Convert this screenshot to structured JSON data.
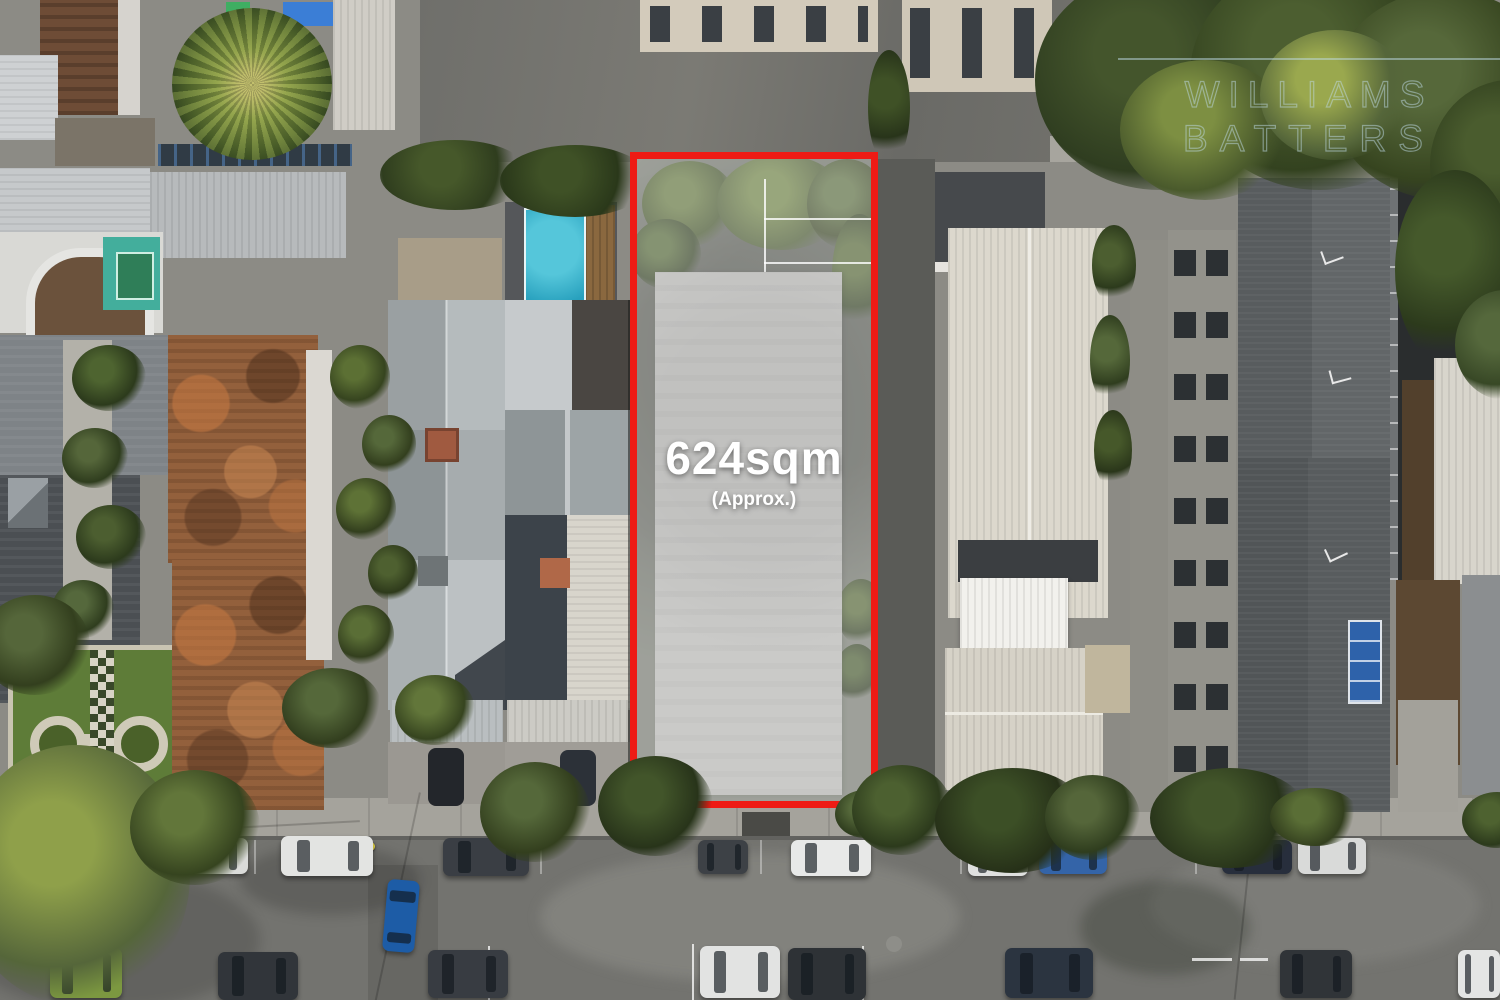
{
  "image": {
    "description": "Aerial drone photograph of an inner-suburban block; a vacant development site is outlined in red with its land area labelled.",
    "lot_label": {
      "area": "624sqm",
      "qualifier": "(Approx.)"
    },
    "watermark": {
      "line1": "WILLIAMS",
      "line2": "BATTERS"
    },
    "colors": {
      "outline_red": "#ee1b15",
      "overlay_white": "rgba(255,255,255,0.32)",
      "label_text": "#ffffff",
      "watermark_text": "rgba(190,218,230,0.5)",
      "pool_teal": "#27a0bd",
      "terracotta_roof": "#93603c",
      "asphalt": "#73736f"
    }
  },
  "cars": [
    {
      "x": 30,
      "y": 841,
      "w": 54,
      "h": 34,
      "c": "#b9bbbd",
      "o": "h"
    },
    {
      "x": 124,
      "y": 839,
      "w": 46,
      "h": 33,
      "c": "#e6e7e7",
      "o": "h"
    },
    {
      "x": 176,
      "y": 838,
      "w": 72,
      "h": 36,
      "c": "#dadbd9",
      "o": "h"
    },
    {
      "x": 281,
      "y": 836,
      "w": 92,
      "h": 40,
      "c": "#e3e4e2",
      "o": "h"
    },
    {
      "x": 443,
      "y": 838,
      "w": 86,
      "h": 38,
      "c": "#3a3e44",
      "o": "h"
    },
    {
      "x": 698,
      "y": 840,
      "w": 50,
      "h": 34,
      "c": "#3d4146",
      "o": "h"
    },
    {
      "x": 791,
      "y": 840,
      "w": 80,
      "h": 36,
      "c": "#e8e9e8",
      "o": "h"
    },
    {
      "x": 968,
      "y": 842,
      "w": 60,
      "h": 34,
      "c": "#dfe0df",
      "o": "h"
    },
    {
      "x": 1039,
      "y": 840,
      "w": 68,
      "h": 34,
      "c": "#3464a8",
      "o": "h"
    },
    {
      "x": 1222,
      "y": 840,
      "w": 70,
      "h": 34,
      "c": "#272e3c",
      "o": "h"
    },
    {
      "x": 1298,
      "y": 838,
      "w": 68,
      "h": 36,
      "c": "#d9dad9",
      "o": "h"
    },
    {
      "x": 385,
      "y": 880,
      "w": 32,
      "h": 72,
      "c": "#1d5ca6",
      "o": "v",
      "deg": 5
    },
    {
      "x": 50,
      "y": 948,
      "w": 72,
      "h": 50,
      "c": "#7c9840",
      "o": "h"
    },
    {
      "x": 218,
      "y": 952,
      "w": 80,
      "h": 48,
      "c": "#31353a",
      "o": "h"
    },
    {
      "x": 428,
      "y": 950,
      "w": 80,
      "h": 48,
      "c": "#383c42",
      "o": "h"
    },
    {
      "x": 700,
      "y": 946,
      "w": 80,
      "h": 52,
      "c": "#e2e3e2",
      "o": "h"
    },
    {
      "x": 788,
      "y": 948,
      "w": 78,
      "h": 52,
      "c": "#2e3236",
      "o": "h"
    },
    {
      "x": 1005,
      "y": 948,
      "w": 88,
      "h": 50,
      "c": "#2b3440",
      "o": "h"
    },
    {
      "x": 1280,
      "y": 950,
      "w": 72,
      "h": 48,
      "c": "#303438",
      "o": "h"
    },
    {
      "x": 1458,
      "y": 950,
      "w": 42,
      "h": 48,
      "c": "#e4e5e4",
      "o": "h"
    }
  ],
  "trees": [
    {
      "layer": "scene",
      "x": 1035,
      "y": -30,
      "w": 250,
      "h": 220,
      "c1": "#44552c",
      "c2": "#2f3d20"
    },
    {
      "layer": "scene",
      "x": 1190,
      "y": -40,
      "w": 260,
      "h": 230,
      "c1": "#4c5e30",
      "c2": "#33421f"
    },
    {
      "layer": "scene",
      "x": 1330,
      "y": -10,
      "w": 230,
      "h": 210,
      "c1": "#56683a",
      "c2": "#36441f"
    },
    {
      "layer": "scene",
      "x": 1430,
      "y": 80,
      "w": 160,
      "h": 170,
      "c1": "#4a5c2e",
      "c2": "#2f3d1d"
    },
    {
      "layer": "scene",
      "x": 1120,
      "y": 60,
      "w": 170,
      "h": 140,
      "c1": "#7d8f42",
      "c2": "#4a5a2c"
    },
    {
      "layer": "scene",
      "x": 1260,
      "y": 30,
      "w": 150,
      "h": 130,
      "c1": "#9aa84e",
      "c2": "#55663a"
    },
    {
      "layer": "scene",
      "x": 1395,
      "y": 170,
      "w": 120,
      "h": 200,
      "c1": "#45592b",
      "c2": "#2c3a1c"
    },
    {
      "layer": "scene",
      "x": 1455,
      "y": 290,
      "w": 100,
      "h": 110,
      "c1": "#55683c",
      "c2": "#384826"
    },
    {
      "layer": "scene",
      "x": 380,
      "y": 140,
      "w": 150,
      "h": 70,
      "c1": "#46582a",
      "c2": "#2f3d1e"
    },
    {
      "layer": "scene",
      "x": 500,
      "y": 145,
      "w": 150,
      "h": 72,
      "c1": "#3f5126",
      "c2": "#2a381a"
    },
    {
      "layer": "scene",
      "x": 868,
      "y": 50,
      "w": 42,
      "h": 115,
      "c1": "#3f5126",
      "c2": "#28341a"
    },
    {
      "layer": "scene",
      "x": 330,
      "y": 345,
      "w": 60,
      "h": 64,
      "c1": "#5c7034",
      "c2": "#36441f"
    },
    {
      "layer": "scene",
      "x": 362,
      "y": 415,
      "w": 54,
      "h": 58,
      "c1": "#55683a",
      "c2": "#333f1e"
    },
    {
      "layer": "scene",
      "x": 336,
      "y": 478,
      "w": 60,
      "h": 62,
      "c1": "#5e7236",
      "c2": "#333f1e"
    },
    {
      "layer": "scene",
      "x": 368,
      "y": 545,
      "w": 50,
      "h": 56,
      "c1": "#4e6030",
      "c2": "#2e3a1b"
    },
    {
      "layer": "scene",
      "x": 338,
      "y": 605,
      "w": 56,
      "h": 60,
      "c1": "#5a6e36",
      "c2": "#333f1e"
    },
    {
      "layer": "scene",
      "x": 282,
      "y": 668,
      "w": 100,
      "h": 80,
      "c1": "#55683a",
      "c2": "#323e1e"
    },
    {
      "layer": "scene",
      "x": 395,
      "y": 675,
      "w": 80,
      "h": 70,
      "c1": "#62763a",
      "c2": "#36441f"
    },
    {
      "layer": "scene",
      "x": 72,
      "y": 345,
      "w": 74,
      "h": 66,
      "c1": "#4e6430",
      "c2": "#2c3a1c"
    },
    {
      "layer": "scene",
      "x": 62,
      "y": 428,
      "w": 66,
      "h": 60,
      "c1": "#55663a",
      "c2": "#2f3d1e"
    },
    {
      "layer": "scene",
      "x": 76,
      "y": 505,
      "w": 70,
      "h": 64,
      "c1": "#4c5e30",
      "c2": "#2c3a1c"
    },
    {
      "layer": "scene",
      "x": 52,
      "y": 580,
      "w": 62,
      "h": 58,
      "c1": "#55683c",
      "c2": "#2f3d1e"
    },
    {
      "layer": "scene",
      "x": -20,
      "y": 595,
      "w": 110,
      "h": 100,
      "c1": "#55663a",
      "c2": "#333f1e"
    },
    {
      "layer": "scene",
      "x": 1092,
      "y": 225,
      "w": 44,
      "h": 80,
      "c1": "#4c5e30",
      "c2": "#2c3a1c"
    },
    {
      "layer": "scene",
      "x": 1090,
      "y": 315,
      "w": 40,
      "h": 90,
      "c1": "#55683a",
      "c2": "#2f3d1e"
    },
    {
      "layer": "scene",
      "x": 1094,
      "y": 410,
      "w": 38,
      "h": 80,
      "c1": "#46582a",
      "c2": "#2a361a"
    },
    {
      "layer": "site",
      "x": 5,
      "y": 2,
      "w": 95,
      "h": 85,
      "c1": "#5d7038",
      "c2": "#3c4c24"
    },
    {
      "layer": "site",
      "x": 80,
      "y": -4,
      "w": 130,
      "h": 95,
      "c1": "#687c3e",
      "c2": "#42522a"
    },
    {
      "layer": "site",
      "x": 170,
      "y": 0,
      "w": 80,
      "h": 90,
      "c1": "#55683a",
      "c2": "#333f1e"
    },
    {
      "layer": "site",
      "x": -6,
      "y": 60,
      "w": 70,
      "h": 70,
      "c1": "#4c6030",
      "c2": "#2c3a1c"
    },
    {
      "layer": "site",
      "x": 195,
      "y": 55,
      "w": 55,
      "h": 120,
      "c1": "#4e6030",
      "c2": "#2c3a1c"
    },
    {
      "layer": "site",
      "x": 200,
      "y": 420,
      "w": 48,
      "h": 66,
      "c1": "#4e6030",
      "c2": "#2c3a1c"
    },
    {
      "layer": "site",
      "x": 198,
      "y": 485,
      "w": 44,
      "h": 58,
      "c1": "#42552a",
      "c2": "#28341a"
    },
    {
      "layer": "street",
      "x": -40,
      "y": 745,
      "w": 230,
      "h": 260,
      "c1": "#8fa04a",
      "c2": "#55663a"
    },
    {
      "layer": "street",
      "x": 130,
      "y": 770,
      "w": 130,
      "h": 115,
      "c1": "#62763a",
      "c2": "#36441f"
    },
    {
      "layer": "street",
      "x": 480,
      "y": 762,
      "w": 110,
      "h": 100,
      "c1": "#55683a",
      "c2": "#333f1e"
    },
    {
      "layer": "street",
      "x": 598,
      "y": 756,
      "w": 115,
      "h": 100,
      "c1": "#42552a",
      "c2": "#28341a"
    },
    {
      "layer": "street",
      "x": 835,
      "y": 790,
      "w": 60,
      "h": 48,
      "c1": "#55683a",
      "c2": "#2f3d1e"
    },
    {
      "layer": "street",
      "x": 852,
      "y": 765,
      "w": 100,
      "h": 90,
      "c1": "#4c6030",
      "c2": "#2c3a1c"
    },
    {
      "layer": "street",
      "x": 935,
      "y": 768,
      "w": 155,
      "h": 105,
      "c1": "#3c4f26",
      "c2": "#263018"
    },
    {
      "layer": "street",
      "x": 1045,
      "y": 775,
      "w": 95,
      "h": 85,
      "c1": "#55663a",
      "c2": "#2f3d1e"
    },
    {
      "layer": "street",
      "x": 1150,
      "y": 768,
      "w": 160,
      "h": 100,
      "c1": "#42552a",
      "c2": "#28341a"
    },
    {
      "layer": "street",
      "x": 1270,
      "y": 788,
      "w": 90,
      "h": 58,
      "c1": "#5a6e36",
      "c2": "#333f1e"
    },
    {
      "layer": "street",
      "x": 1462,
      "y": 792,
      "w": 70,
      "h": 56,
      "c1": "#4e6230",
      "c2": "#2c3a1c"
    }
  ]
}
